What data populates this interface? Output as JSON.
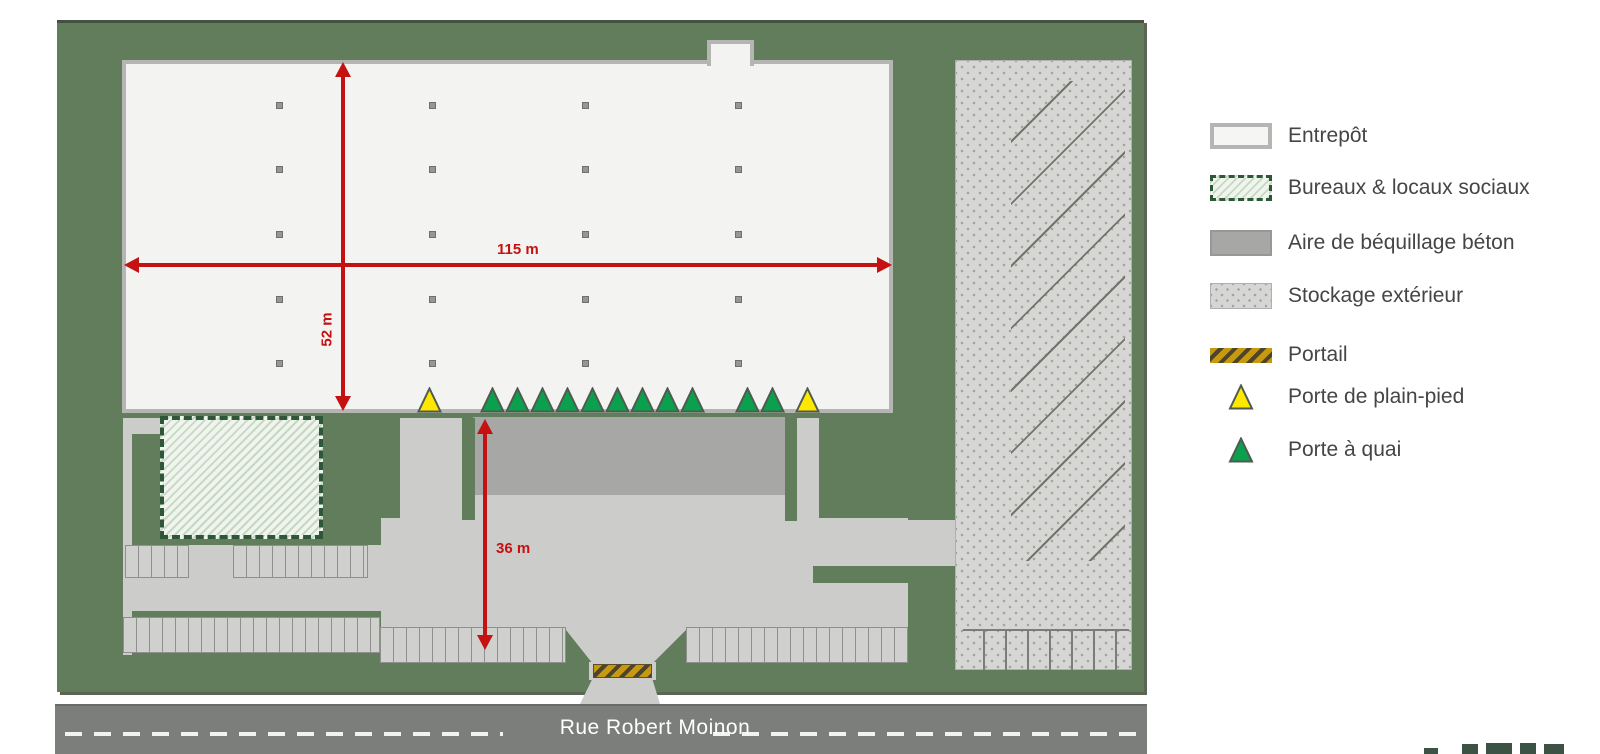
{
  "street": {
    "name": "Rue Robert Moinon"
  },
  "dimensions": {
    "building_width": "115 m",
    "building_depth": "52 m",
    "yard_depth": "36 m"
  },
  "legend": {
    "items": [
      {
        "key": "entrepot",
        "label": "Entrepôt"
      },
      {
        "key": "bureaux",
        "label": "Bureaux & locaux sociaux"
      },
      {
        "key": "aire",
        "label": "Aire de béquillage béton"
      },
      {
        "key": "stockage",
        "label": "Stockage extérieur"
      },
      {
        "key": "portail",
        "label": "Portail"
      },
      {
        "key": "plain_pied",
        "label": "Porte de plain-pied"
      },
      {
        "key": "quai",
        "label": "Porte à quai"
      }
    ]
  },
  "plan": {
    "doors": [
      {
        "type": "plain-pied",
        "x": 417
      },
      {
        "type": "quai",
        "x": 480
      },
      {
        "type": "quai",
        "x": 505
      },
      {
        "type": "quai",
        "x": 530
      },
      {
        "type": "quai",
        "x": 555
      },
      {
        "type": "quai",
        "x": 580
      },
      {
        "type": "quai",
        "x": 605
      },
      {
        "type": "quai",
        "x": 630
      },
      {
        "type": "quai",
        "x": 655
      },
      {
        "type": "quai",
        "x": 680
      },
      {
        "type": "quai",
        "x": 735
      },
      {
        "type": "quai",
        "x": 760
      },
      {
        "type": "plain-pied",
        "x": 795
      }
    ],
    "door_row_y": 387,
    "columns_grid": {
      "cols": [
        276,
        429,
        582,
        735
      ],
      "rows": [
        102,
        166,
        231,
        296,
        360
      ]
    }
  },
  "colors": {
    "site_green": "#627d5b",
    "building_fill": "#f3f3f1",
    "building_border": "#b5b5b3",
    "concrete_dark": "#a7a7a5",
    "tarmac": "#cccccb",
    "stockage_fill": "#d6d6d4",
    "street_gray": "#7b7e7b",
    "dimension_red": "#c41111",
    "door_quai": "#0aa04d",
    "door_plain_pied": "#ffe800",
    "door_stroke": "#4f5a50",
    "gate_gold": "#c6990f",
    "office_hatch": "#c6d8c1",
    "legend_text": "#454545",
    "logo_green": "#3c5244"
  },
  "logo": {
    "visibility": "partial, clipped at bottom edge"
  }
}
